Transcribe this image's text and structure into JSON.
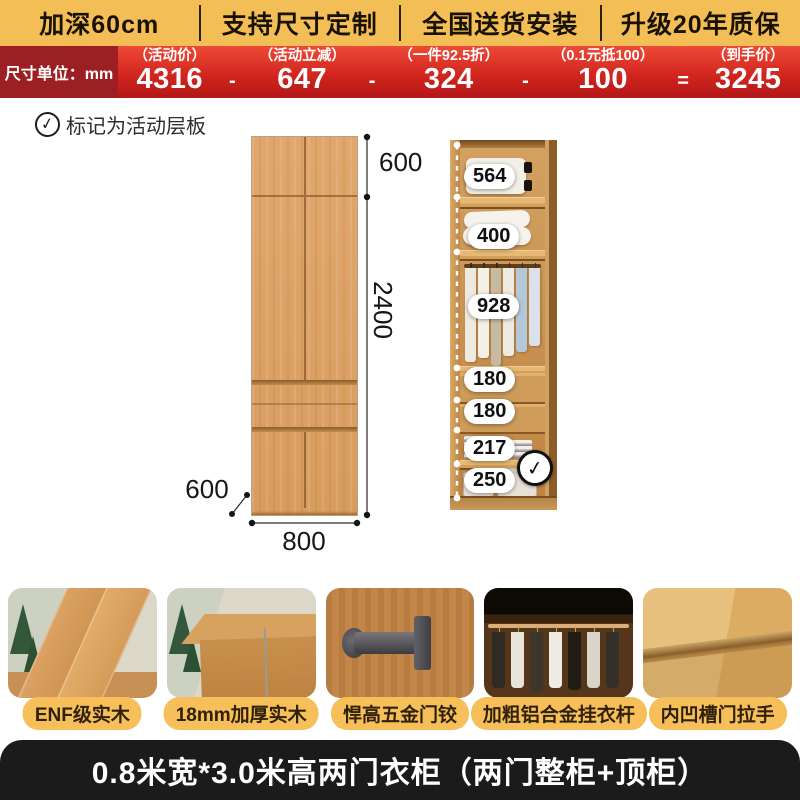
{
  "topbar": {
    "items": [
      {
        "label": "加深60cm"
      },
      {
        "label": "支持尺寸定制"
      },
      {
        "label": "全国送货安装"
      },
      {
        "label": "升级20年质保"
      }
    ]
  },
  "pricebar": {
    "unit_label": "尺寸单位：mm",
    "groups": [
      {
        "tag": "（活动价）",
        "value": "4316"
      },
      {
        "tag": "（活动立减）",
        "value": "647"
      },
      {
        "tag": "（一件92.5折）",
        "value": "324"
      },
      {
        "tag": "（0.1元抵100）",
        "value": "100"
      },
      {
        "tag": "（到手价）",
        "value": "3245"
      }
    ],
    "operators": [
      "-",
      "-",
      "-",
      "="
    ]
  },
  "legend": {
    "check_glyph": "✓",
    "text": "标记为活动层板"
  },
  "front_view": {
    "top_cabinet_height": "600",
    "body_height": "2400",
    "width": "800",
    "depth": "600"
  },
  "interior_view": {
    "labels": [
      "564",
      "400",
      "928",
      "180",
      "180",
      "217",
      "250"
    ],
    "shelf_check_glyph": "✓"
  },
  "features": [
    {
      "label": "ENF级实木"
    },
    {
      "label": "18mm加厚实木"
    },
    {
      "label": "悍高五金门铰"
    },
    {
      "label": "加粗铝合金挂衣杆"
    },
    {
      "label": "内凹槽门拉手"
    }
  ],
  "footer": {
    "title": "0.8米宽*3.0米高两门衣柜（两门整柜+顶柜）"
  },
  "colors": {
    "accent_yellow": "#F2BE55",
    "price_red": "#D2261F",
    "dark_red": "#9C2023",
    "wood": "#DCA266",
    "pill_yellow": "#F6BF59",
    "footer_black": "#1B1B1B"
  }
}
